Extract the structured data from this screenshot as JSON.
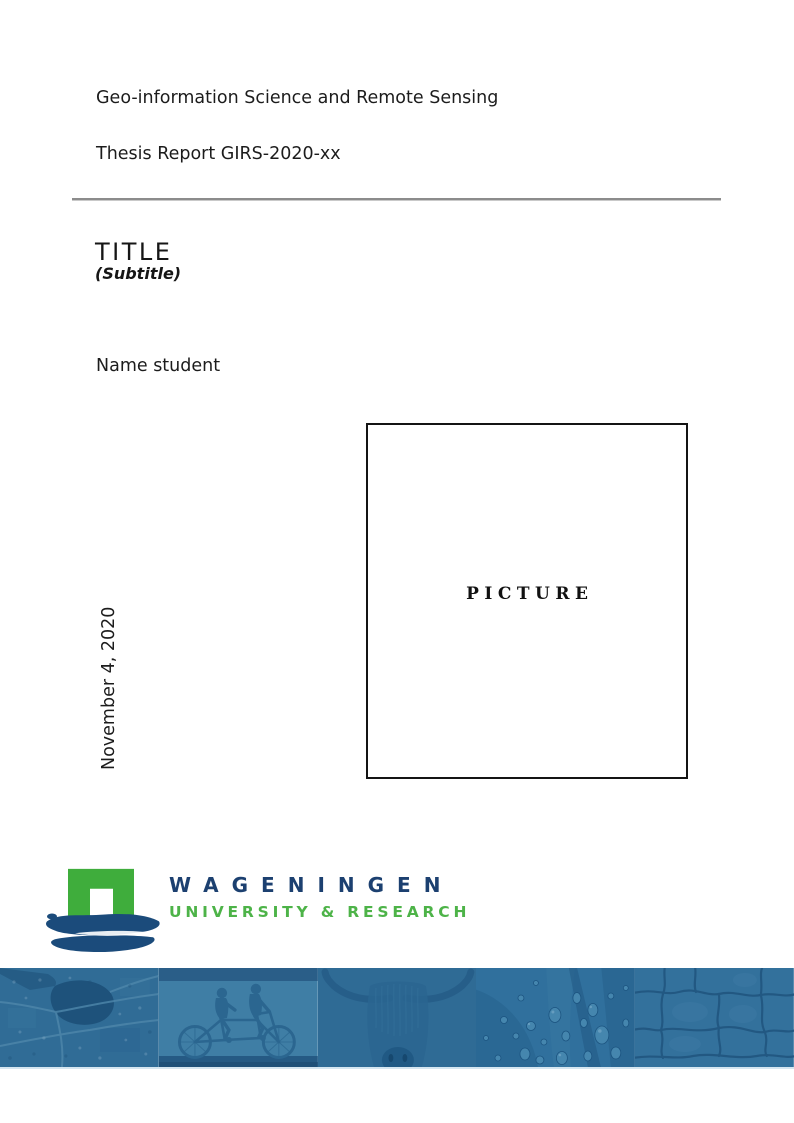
{
  "header": {
    "department": "Geo-information Science and Remote Sensing",
    "report_id": "Thesis Report GIRS-2020-xx"
  },
  "title_block": {
    "title": "TITLE",
    "subtitle": "(Subtitle)",
    "author": "Name student",
    "date": "November 4, 2020"
  },
  "picture": {
    "placeholder": "PICTURE"
  },
  "logo": {
    "wordmark": "WAGENINGEN",
    "tagline": "UNIVERSITY & RESEARCH",
    "colors": {
      "green": "#3fad3c",
      "text_green": "#4db348",
      "navy": "#1c4070",
      "brush_navy": "#1b4b7b"
    }
  },
  "banner": {
    "tint": "#2f6b95",
    "photos": [
      {
        "name": "aerial-map"
      },
      {
        "name": "tandem-cyclists"
      },
      {
        "name": "highland-cow"
      },
      {
        "name": "leaf-water-droplets"
      },
      {
        "name": "cracked-earth"
      }
    ]
  }
}
